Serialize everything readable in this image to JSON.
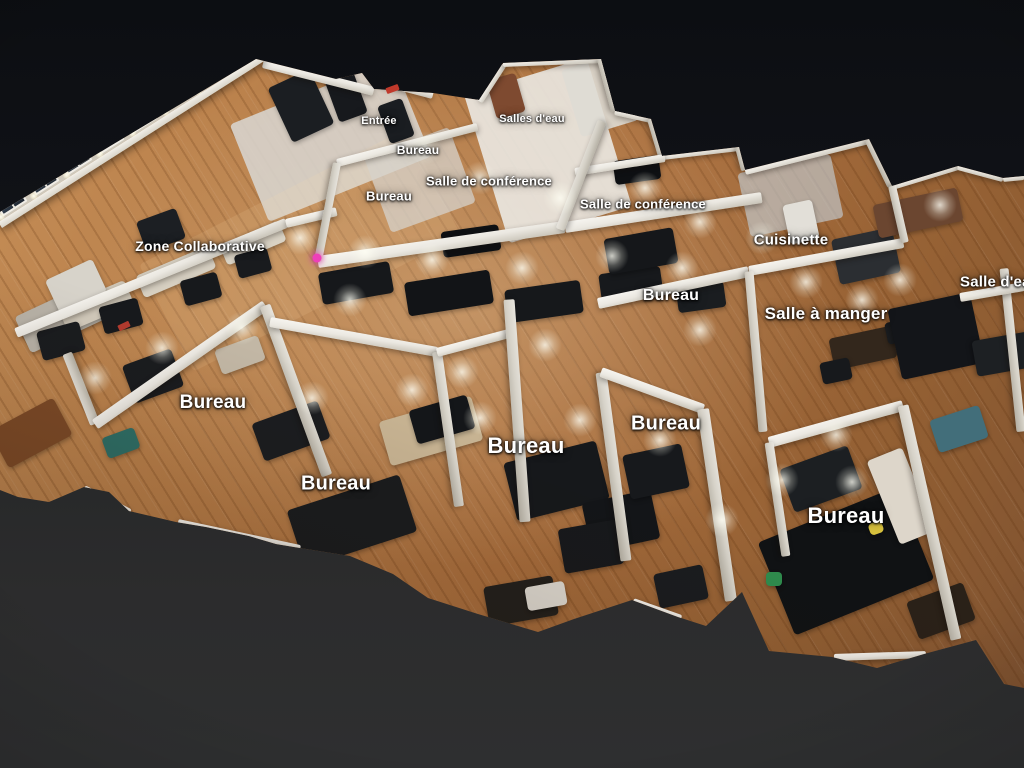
{
  "view": {
    "type": "3d-dollhouse-office-scan",
    "background_top": "#0c0e12",
    "background_bottom": "#2e2f30"
  },
  "palette": {
    "wall_light": "#f7f5f0",
    "wall_shade": "#b2ada1",
    "wood_light": "#c68f58",
    "wood_dark": "#7d5130",
    "window_pane": "#2c3744",
    "label_color": "#ffffff",
    "tag_pink": "#ee3fb9",
    "exit_red": "#c0392b"
  },
  "room_labels": [
    {
      "text": "Entrée",
      "x": 379,
      "y": 121,
      "size": 11
    },
    {
      "text": "Bureau",
      "x": 418,
      "y": 150,
      "size": 12
    },
    {
      "text": "Salles d'eau",
      "x": 532,
      "y": 119,
      "size": 11
    },
    {
      "text": "Salle de conférence",
      "x": 489,
      "y": 181,
      "size": 13
    },
    {
      "text": "Bureau",
      "x": 389,
      "y": 196,
      "size": 13
    },
    {
      "text": "Salle de conférence",
      "x": 643,
      "y": 204,
      "size": 13
    },
    {
      "text": "Zone Collaborative",
      "x": 200,
      "y": 246,
      "size": 14
    },
    {
      "text": "Cuisinette",
      "x": 791,
      "y": 240,
      "size": 15
    },
    {
      "text": "Bureau",
      "x": 671,
      "y": 296,
      "size": 16
    },
    {
      "text": "Salle à manger",
      "x": 826,
      "y": 314,
      "size": 17
    },
    {
      "text": "Salle d'eau",
      "x": 1000,
      "y": 282,
      "size": 15
    },
    {
      "text": "Bureau",
      "x": 213,
      "y": 403,
      "size": 19
    },
    {
      "text": "Bureau",
      "x": 336,
      "y": 484,
      "size": 20
    },
    {
      "text": "Bureau",
      "x": 526,
      "y": 446,
      "size": 22
    },
    {
      "text": "Bureau",
      "x": 666,
      "y": 424,
      "size": 20
    },
    {
      "text": "Bureau",
      "x": 846,
      "y": 516,
      "size": 22
    }
  ],
  "markers": {
    "tag": {
      "x": 317,
      "y": 258,
      "color": "#ee3fb9"
    },
    "exit_signs": [
      {
        "x": 392,
        "y": 89,
        "w": 13,
        "h": 6,
        "r": -20,
        "color": "#c0392b"
      },
      {
        "x": 124,
        "y": 326,
        "w": 12,
        "h": 6,
        "r": -25,
        "color": "#b03a2e"
      }
    ]
  },
  "scene": {
    "floor_outline": [
      [
        0,
        212
      ],
      [
        256,
        59
      ],
      [
        336,
        79
      ],
      [
        362,
        73
      ],
      [
        374,
        89
      ],
      [
        433,
        93
      ],
      [
        479,
        100
      ],
      [
        503,
        63
      ],
      [
        601,
        59
      ],
      [
        615,
        111
      ],
      [
        651,
        119
      ],
      [
        662,
        156
      ],
      [
        739,
        147
      ],
      [
        745,
        170
      ],
      [
        869,
        139
      ],
      [
        892,
        186
      ],
      [
        958,
        166
      ],
      [
        1003,
        178
      ],
      [
        1024,
        176
      ],
      [
        1024,
        688
      ],
      [
        1004,
        684
      ],
      [
        976,
        640
      ],
      [
        924,
        654
      ],
      [
        877,
        668
      ],
      [
        832,
        657
      ],
      [
        769,
        651
      ],
      [
        742,
        592
      ],
      [
        706,
        626
      ],
      [
        678,
        617
      ],
      [
        632,
        600
      ],
      [
        574,
        619
      ],
      [
        538,
        632
      ],
      [
        478,
        614
      ],
      [
        428,
        598
      ],
      [
        393,
        574
      ],
      [
        350,
        556
      ],
      [
        300,
        548
      ],
      [
        276,
        544
      ],
      [
        249,
        536
      ],
      [
        206,
        527
      ],
      [
        176,
        522
      ],
      [
        129,
        511
      ],
      [
        109,
        492
      ],
      [
        84,
        487
      ],
      [
        49,
        502
      ],
      [
        18,
        497
      ],
      [
        0,
        490
      ]
    ],
    "window_wall": {
      "x": 2,
      "y": 228,
      "length": 312,
      "angle": -32.5,
      "band": 46,
      "window_count": 8
    },
    "walls": [
      [
        263,
        63,
        374,
        91,
        9,
        0
      ],
      [
        372,
        79,
        433,
        95,
        8,
        0
      ],
      [
        479,
        101,
        503,
        64,
        8,
        0
      ],
      [
        503,
        63,
        601,
        59,
        8,
        0
      ],
      [
        601,
        59,
        615,
        111,
        8,
        1
      ],
      [
        615,
        111,
        651,
        119,
        8,
        0
      ],
      [
        651,
        119,
        662,
        156,
        8,
        1
      ],
      [
        662,
        156,
        739,
        147,
        8,
        0
      ],
      [
        739,
        147,
        745,
        170,
        8,
        1
      ],
      [
        745,
        170,
        869,
        139,
        9,
        0
      ],
      [
        869,
        139,
        892,
        186,
        9,
        1
      ],
      [
        892,
        186,
        958,
        166,
        8,
        0
      ],
      [
        958,
        166,
        1003,
        178,
        8,
        0
      ],
      [
        1003,
        178,
        1024,
        176,
        8,
        0
      ],
      [
        16,
        333,
        286,
        223,
        10,
        0
      ],
      [
        286,
        223,
        337,
        211,
        9,
        0
      ],
      [
        318,
        262,
        565,
        227,
        12,
        0
      ],
      [
        337,
        163,
        477,
        127,
        8,
        0
      ],
      [
        337,
        163,
        318,
        261,
        8,
        1
      ],
      [
        565,
        227,
        762,
        197,
        11,
        0
      ],
      [
        575,
        172,
        665,
        158,
        8,
        0
      ],
      [
        560,
        229,
        602,
        121,
        9,
        1
      ],
      [
        598,
        303,
        749,
        271,
        11,
        0
      ],
      [
        749,
        271,
        903,
        243,
        10,
        0
      ],
      [
        749,
        271,
        763,
        431,
        9,
        1
      ],
      [
        95,
        424,
        67,
        353,
        10,
        1
      ],
      [
        95,
        424,
        265,
        305,
        11,
        0
      ],
      [
        265,
        305,
        327,
        475,
        11,
        1
      ],
      [
        270,
        322,
        437,
        352,
        10,
        0
      ],
      [
        437,
        352,
        459,
        506,
        10,
        1
      ],
      [
        437,
        352,
        509,
        333,
        9,
        0
      ],
      [
        509,
        299,
        525,
        521,
        11,
        1
      ],
      [
        601,
        372,
        626,
        560,
        11,
        1
      ],
      [
        601,
        372,
        703,
        409,
        10,
        0
      ],
      [
        703,
        409,
        731,
        601,
        12,
        1
      ],
      [
        769,
        442,
        903,
        405,
        11,
        0
      ],
      [
        903,
        405,
        956,
        639,
        11,
        1
      ],
      [
        769,
        442,
        786,
        556,
        9,
        1
      ],
      [
        834,
        657,
        926,
        654,
        7,
        0
      ],
      [
        633,
        601,
        681,
        618,
        7,
        0
      ],
      [
        84,
        488,
        130,
        512,
        7,
        0
      ],
      [
        178,
        522,
        300,
        548,
        7,
        0
      ],
      [
        1004,
        268,
        1021,
        431,
        9,
        1
      ],
      [
        960,
        297,
        1024,
        286,
        9,
        0
      ],
      [
        892,
        186,
        905,
        243,
        8,
        1
      ]
    ],
    "overlays": [
      [
        330,
        140,
        175,
        105,
        -22,
        "#d8d5cf",
        0.88
      ],
      [
        548,
        150,
        128,
        155,
        -17,
        "#e9e6e0",
        0.92
      ],
      [
        600,
        95,
        60,
        70,
        -17,
        "#dedbd4",
        0.9
      ],
      [
        300,
        250,
        300,
        120,
        -27,
        "#ffdfae",
        0.12
      ],
      [
        790,
        195,
        95,
        65,
        -12,
        "#c3ccd2",
        0.65
      ],
      [
        420,
        180,
        90,
        80,
        -20,
        "#d5d2cb",
        0.75
      ]
    ],
    "furniture": [
      [
        60,
        318,
        82,
        40,
        -25,
        "#b9b3a8"
      ],
      [
        96,
        306,
        72,
        26,
        -23,
        "#d2cabb"
      ],
      [
        176,
        272,
        78,
        24,
        -23,
        "#d6cfc1"
      ],
      [
        253,
        243,
        64,
        22,
        -23,
        "#d9d2c4"
      ],
      [
        121,
        316,
        40,
        28,
        -15,
        "#17191c"
      ],
      [
        201,
        289,
        38,
        26,
        -15,
        "#17191c"
      ],
      [
        253,
        263,
        34,
        24,
        -15,
        "#191b1e"
      ],
      [
        61,
        341,
        44,
        30,
        -15,
        "#1a1c1f"
      ],
      [
        161,
        230,
        42,
        32,
        -20,
        "#1c1f23"
      ],
      [
        356,
        283,
        72,
        32,
        -10,
        "#16181b"
      ],
      [
        449,
        293,
        86,
        34,
        -9,
        "#121417"
      ],
      [
        544,
        301,
        76,
        33,
        -8,
        "#16181b"
      ],
      [
        631,
        285,
        62,
        30,
        -8,
        "#17191c"
      ],
      [
        701,
        297,
        48,
        26,
        -8,
        "#1a1d20"
      ],
      [
        471,
        241,
        58,
        26,
        -8,
        "#0e1013"
      ],
      [
        637,
        170,
        46,
        24,
        -8,
        "#0e1013"
      ],
      [
        866,
        256,
        62,
        46,
        -12,
        "#2b2e32"
      ],
      [
        918,
        213,
        86,
        34,
        -12,
        "#6b4630"
      ],
      [
        801,
        222,
        30,
        40,
        -12,
        "#e2dfd8"
      ],
      [
        863,
        348,
        64,
        32,
        -12,
        "#33271c"
      ],
      [
        901,
        331,
        30,
        22,
        -12,
        "#1a1c1f"
      ],
      [
        836,
        371,
        30,
        22,
        -12,
        "#17191c"
      ],
      [
        291,
        431,
        70,
        40,
        -20,
        "#1b1d20"
      ],
      [
        352,
        521,
        118,
        60,
        -18,
        "#1a1c1e"
      ],
      [
        431,
        431,
        96,
        46,
        -16,
        "#c8b493"
      ],
      [
        442,
        419,
        60,
        35,
        -16,
        "#141619"
      ],
      [
        556,
        481,
        95,
        60,
        -14,
        "#16181b"
      ],
      [
        621,
        521,
        70,
        50,
        -12,
        "#131518"
      ],
      [
        656,
        471,
        60,
        45,
        -12,
        "#17191c"
      ],
      [
        846,
        561,
        150,
        100,
        -22,
        "#101214"
      ],
      [
        901,
        496,
        90,
        38,
        68,
        "#ddd6ca"
      ],
      [
        821,
        479,
        72,
        46,
        -20,
        "#1c1f22"
      ],
      [
        876,
        528,
        14,
        12,
        -20,
        "#d8c23e"
      ],
      [
        941,
        611,
        60,
        40,
        -20,
        "#2a2118"
      ],
      [
        936,
        336,
        72,
        84,
        78,
        "#131519"
      ],
      [
        1009,
        353,
        36,
        70,
        80,
        "#1d2023"
      ],
      [
        959,
        429,
        52,
        34,
        -18,
        "#426e7a"
      ],
      [
        31,
        433,
        72,
        42,
        -28,
        "#7c4a27"
      ],
      [
        121,
        443,
        34,
        22,
        -20,
        "#2e6e66"
      ],
      [
        76,
        286,
        52,
        36,
        -25,
        "#d7d3ca"
      ],
      [
        346,
        96,
        30,
        46,
        -20,
        "#17191d"
      ],
      [
        396,
        121,
        26,
        40,
        -20,
        "#1a1d21"
      ],
      [
        301,
        106,
        46,
        60,
        -25,
        "#1b1e22"
      ],
      [
        506,
        96,
        30,
        40,
        -16,
        "#7e4a30"
      ],
      [
        641,
        251,
        70,
        36,
        -10,
        "#15171a"
      ],
      [
        591,
        546,
        60,
        45,
        -10,
        "#17191c"
      ],
      [
        681,
        586,
        50,
        35,
        -12,
        "#1a1c1f"
      ],
      [
        521,
        601,
        70,
        40,
        -10,
        "#23201c"
      ],
      [
        546,
        596,
        40,
        24,
        -10,
        "#ddd8cf"
      ],
      [
        774,
        579,
        16,
        14,
        0,
        "#2f8d4e"
      ],
      [
        240,
        355,
        46,
        26,
        -20,
        "#c2b7a5"
      ],
      [
        153,
        376,
        52,
        40,
        -20,
        "#1a1c1f"
      ]
    ],
    "lights": [
      [
        365,
        252
      ],
      [
        300,
        238
      ],
      [
        432,
        260
      ],
      [
        522,
        268
      ],
      [
        612,
        256
      ],
      [
        682,
        268
      ],
      [
        480,
        178
      ],
      [
        425,
        148
      ],
      [
        560,
        198
      ],
      [
        645,
        188
      ],
      [
        700,
        222
      ],
      [
        762,
        238
      ],
      [
        806,
        282
      ],
      [
        862,
        300
      ],
      [
        580,
        420
      ],
      [
        480,
        418
      ],
      [
        660,
        440
      ],
      [
        782,
        480
      ],
      [
        852,
        482
      ],
      [
        242,
        328
      ],
      [
        162,
        348
      ],
      [
        95,
        378
      ],
      [
        312,
        398
      ],
      [
        412,
        390
      ],
      [
        900,
        280
      ],
      [
        940,
        205
      ],
      [
        700,
        330
      ],
      [
        545,
        345
      ],
      [
        462,
        372
      ],
      [
        836,
        435
      ],
      [
        722,
        520
      ],
      [
        350,
        300
      ]
    ]
  }
}
